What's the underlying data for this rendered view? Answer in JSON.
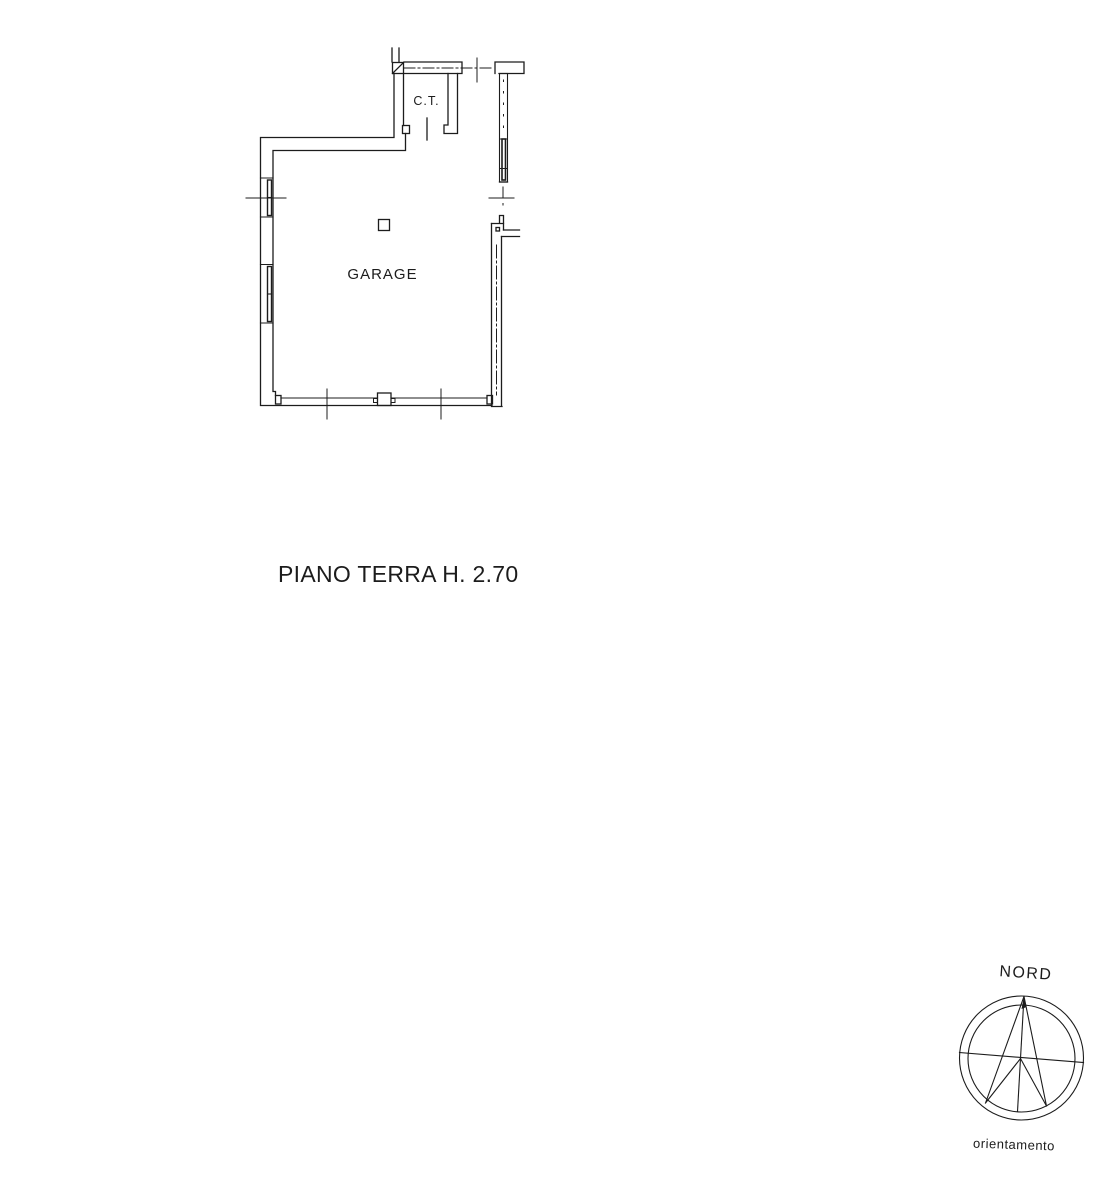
{
  "page": {
    "background": "#ffffff",
    "ink": "#1c1c1c"
  },
  "plan": {
    "labels": {
      "ct_room": "C.T.",
      "garage": "GARAGE"
    },
    "caption": "PIANO TERRA H. 2.70"
  },
  "compass": {
    "north": "NORD",
    "caption": "orientamento"
  }
}
